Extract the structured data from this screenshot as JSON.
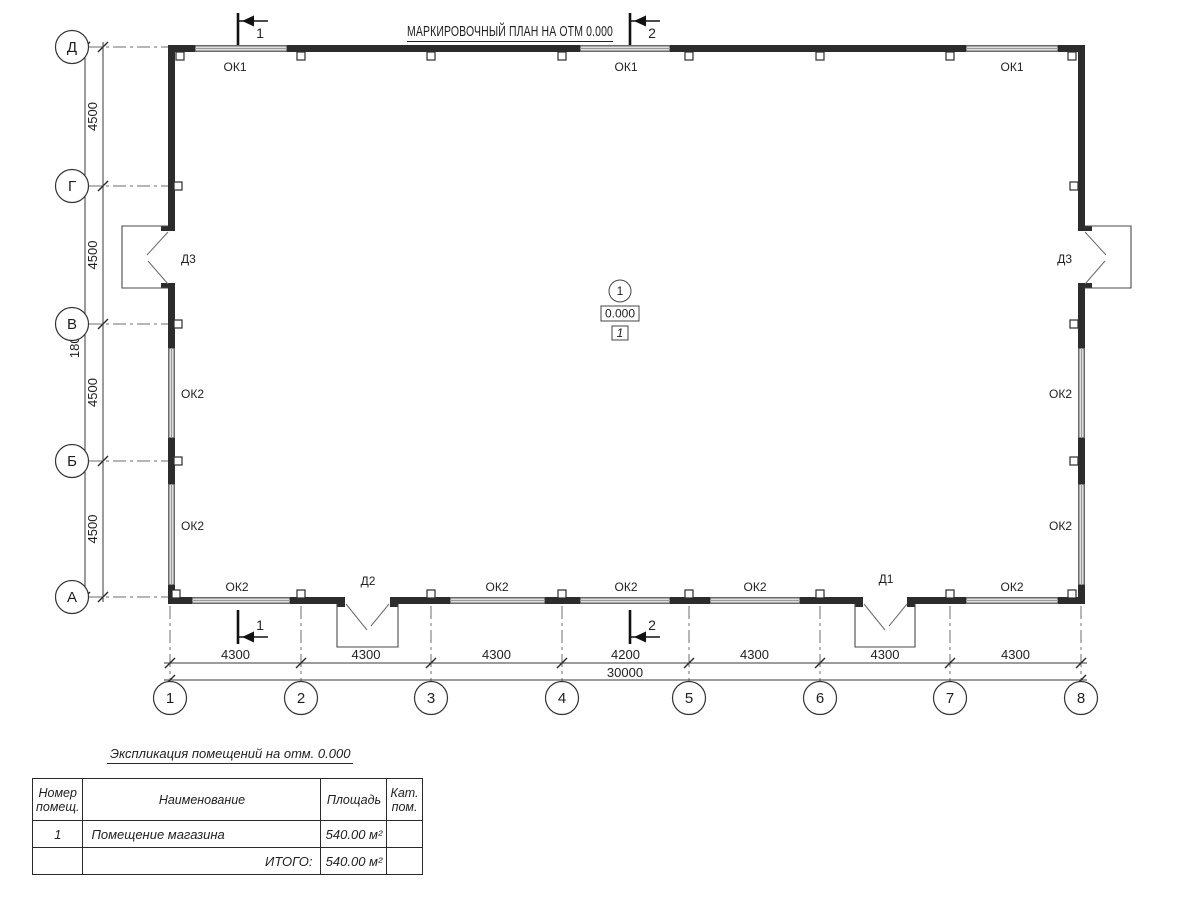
{
  "drawing": {
    "title": "МАРКИРОВОЧНЫЙ ПЛАН НА ОТМ 0.000",
    "axes": {
      "horizontal": [
        "1",
        "2",
        "3",
        "4",
        "5",
        "6",
        "7",
        "8"
      ],
      "vertical": [
        "Д",
        "Г",
        "В",
        "Б",
        "А"
      ]
    },
    "dimensions": {
      "bottom_bays": [
        "4300",
        "4300",
        "4300",
        "4200",
        "4300",
        "4300",
        "4300"
      ],
      "bottom_total": "30000",
      "left_bays": [
        "4500",
        "4500",
        "4500",
        "4500"
      ],
      "left_total": "18000"
    },
    "section_marks": {
      "top": [
        "1",
        "2"
      ],
      "bottom": [
        "1",
        "2"
      ]
    },
    "openings": {
      "top_windows": [
        "ОК1",
        "ОК1",
        "ОК1"
      ],
      "bottom_windows": [
        "ОК2",
        "ОК2",
        "ОК2",
        "ОК2",
        "ОК2"
      ],
      "left_windows": [
        "ОК2",
        "ОК2"
      ],
      "right_windows": [
        "ОК2",
        "ОК2"
      ],
      "doors": [
        "Д3",
        "Д2",
        "Д1",
        "Д3"
      ]
    },
    "room_marker": {
      "bubble": "1",
      "elevation": "0.000",
      "room_tag": "1"
    }
  },
  "table": {
    "title": "Экспликация помещений на отм. 0.000",
    "headers": [
      "Номер\nпомещ.",
      "Наименование",
      "Площадь",
      "Кат.\nпом."
    ],
    "rows": [
      [
        "1",
        "Помещение магазина",
        "540.00 м²",
        ""
      ]
    ],
    "total_label": "ИТОГО:",
    "total_value": "540.00 м²"
  }
}
